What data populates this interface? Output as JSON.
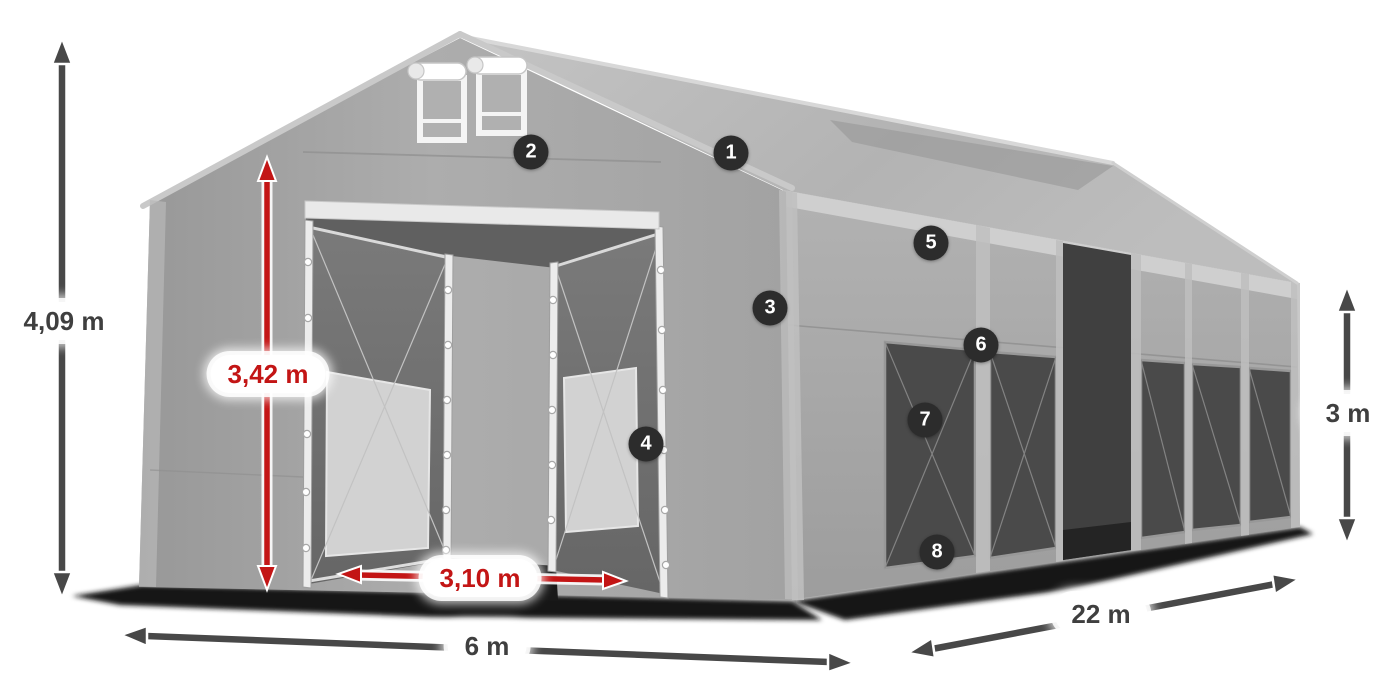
{
  "diagram": {
    "subject": "storage-tent-dimensions",
    "background": "#ffffff"
  },
  "colors": {
    "accent_red": "#c31515",
    "arrow_dark": "#484848",
    "label_text_dark": "#3f3f3f",
    "badge_bg": "#2c2c2c",
    "badge_text": "#ffffff",
    "tent_fabric_light": "#b8b8b8",
    "tent_fabric_mid": "#a8a8a8",
    "tent_interior_dark": "#6a6a6a",
    "window_mesh_dark": "#4a4a4a",
    "ground_shadow": "#131313"
  },
  "dimensions": {
    "total_height": {
      "label": "4,09 m",
      "style": "dark"
    },
    "door_height": {
      "label": "3,42 m",
      "style": "red"
    },
    "door_width": {
      "label": "3,10 m",
      "style": "red"
    },
    "front_width": {
      "label": "6 m",
      "style": "dark"
    },
    "side_length": {
      "label": "22 m",
      "style": "dark"
    },
    "side_height": {
      "label": "3 m",
      "style": "dark"
    }
  },
  "callouts": [
    {
      "number": "1"
    },
    {
      "number": "2"
    },
    {
      "number": "3"
    },
    {
      "number": "4"
    },
    {
      "number": "5"
    },
    {
      "number": "6"
    },
    {
      "number": "7"
    },
    {
      "number": "8"
    }
  ]
}
